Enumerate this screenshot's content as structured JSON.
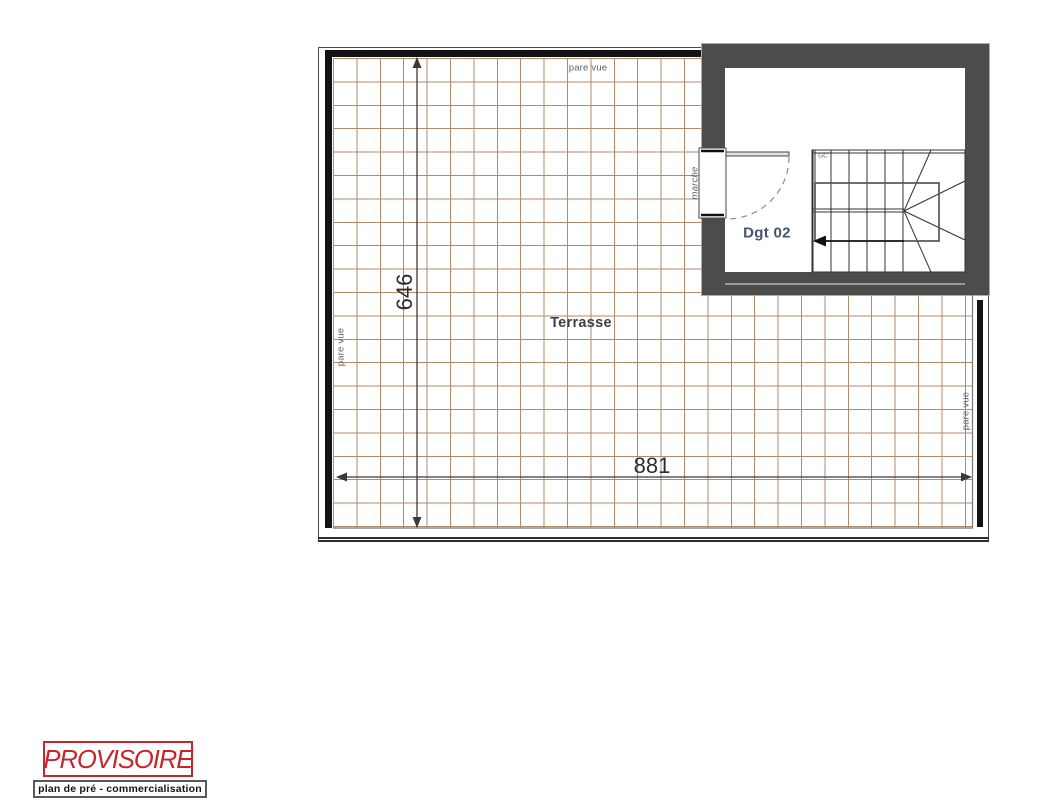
{
  "plan": {
    "terrace_label": "Terrasse",
    "room_label": "Dgt 02",
    "stair_note": "GC",
    "labels": {
      "pare_vue_top": "pare vue",
      "pare_vue_left": "pare vue",
      "pare_vue_right": "pare vue",
      "marche": "marche"
    },
    "dimensions": {
      "terrace_width": "881",
      "terrace_height": "646"
    }
  },
  "stamp": {
    "title": "PROVISOIRE",
    "subtitle": "plan de pré - commercialisation"
  },
  "colors": {
    "tile": "#b38a6c",
    "wall": "#131313",
    "room_wall": "#4b4d4c",
    "dim": "#3a3a3a",
    "label_gray": "#5c5f66",
    "terrasse": "#3d4247",
    "dgt": "#46536e",
    "stamp_red": "#c4262c"
  }
}
